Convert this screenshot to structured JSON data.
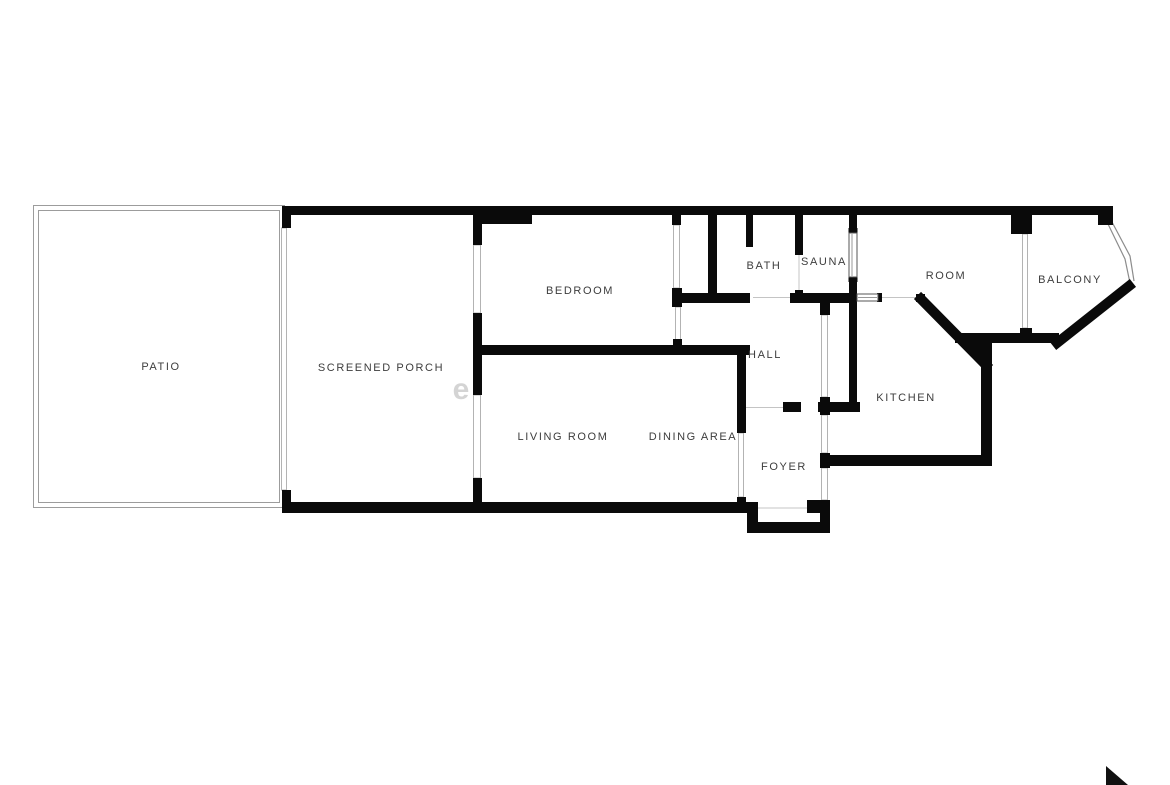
{
  "title": "Apartment floor plan",
  "rooms": [
    {
      "id": "patio",
      "label": "PATIO"
    },
    {
      "id": "screened-porch",
      "label": "SCREENED PORCH"
    },
    {
      "id": "bedroom",
      "label": "BEDROOM"
    },
    {
      "id": "bath",
      "label": "BATH"
    },
    {
      "id": "sauna",
      "label": "SAUNA"
    },
    {
      "id": "room",
      "label": "ROOM"
    },
    {
      "id": "balcony",
      "label": "BALCONY"
    },
    {
      "id": "hall",
      "label": "HALL"
    },
    {
      "id": "living-room",
      "label": "LIVING ROOM"
    },
    {
      "id": "dining-area",
      "label": "DINING AREA"
    },
    {
      "id": "foyer",
      "label": "FOYER"
    },
    {
      "id": "kitchen",
      "label": "KITCHEN"
    }
  ],
  "watermark": {
    "text": "e"
  },
  "cursor": {
    "type": "arrow-cursor"
  },
  "colors": {
    "wall": "#0a0a0a",
    "window_line": "#b3b3b3",
    "patio_outline": "#9c9c9c",
    "label_text": "#3d3d3d",
    "background": "#ffffff"
  }
}
